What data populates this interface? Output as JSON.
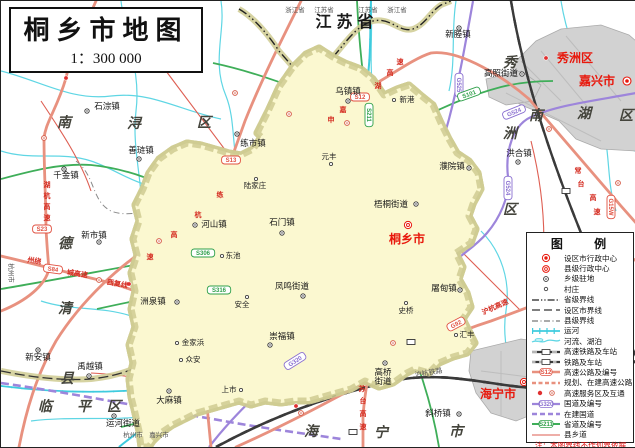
{
  "title": {
    "text": "桐乡市地图",
    "scale": "1：300 000"
  },
  "legend": {
    "title": "图  例",
    "items": [
      {
        "label": "设区市行政中心"
      },
      {
        "label": "县级行政中心"
      },
      {
        "label": "乡级驻地"
      },
      {
        "label": "村庄"
      },
      {
        "label": "省级界线"
      },
      {
        "label": "设区市界线"
      },
      {
        "label": "县级界线"
      },
      {
        "label": "运河"
      },
      {
        "label": "河流、湖泊"
      },
      {
        "label": "高速铁路及车站"
      },
      {
        "label": "铁路及车站"
      },
      {
        "label": "高速公路及编号"
      },
      {
        "label": "规划、在建高速公路"
      },
      {
        "label": "高速服务区及互通"
      },
      {
        "label": "国道及编号"
      },
      {
        "label": "在建国道"
      },
      {
        "label": "省道及编号"
      },
      {
        "label": "县乡道"
      }
    ],
    "badge_expwy": "S12",
    "badge_national": "G320",
    "badge_provincial": "S211",
    "notes": [
      "注：本图界线不作划界依据",
      "地图审核号：浙S(2024)38号"
    ]
  },
  "colors": {
    "land": "#FBF8D0",
    "outside": "#FFFFFF",
    "boundary": "#8C8C3A",
    "halo": "#CFCB92",
    "water": "#4FD2E2",
    "expressway": "#E8917F",
    "national": "#9D85DB",
    "provincial": "#3FAE59",
    "county_road": "#DE5E52",
    "urban_tx": "#F0B45E",
    "urban_gray": "#D2D2D2",
    "red_text": "#E8180C"
  },
  "map": {
    "labels": [
      {
        "t": "江苏省",
        "x": 346,
        "y": 26,
        "c": "prov"
      },
      {
        "t": "浙江省",
        "x": 294,
        "y": 11,
        "c": "bord"
      },
      {
        "t": "江苏省",
        "x": 323,
        "y": 11,
        "c": "bord"
      },
      {
        "t": "江苏省",
        "x": 367,
        "y": 11,
        "c": "bord"
      },
      {
        "t": "浙江省",
        "x": 396,
        "y": 11,
        "c": "bord"
      },
      {
        "t": "杭州市",
        "x": 132,
        "y": 436,
        "c": "bord"
      },
      {
        "t": "嘉兴市",
        "x": 158,
        "y": 436,
        "c": "bord"
      },
      {
        "t": "杭州市",
        "x": 8,
        "y": 272,
        "c": "bord",
        "r": 90
      },
      {
        "t": "南",
        "x": 63,
        "y": 126,
        "c": "dist"
      },
      {
        "t": "浔",
        "x": 133,
        "y": 127,
        "c": "dist"
      },
      {
        "t": "区",
        "x": 203,
        "y": 126,
        "c": "dist"
      },
      {
        "t": "德",
        "x": 64,
        "y": 247,
        "c": "dist"
      },
      {
        "t": "清",
        "x": 64,
        "y": 312,
        "c": "dist"
      },
      {
        "t": "县",
        "x": 66,
        "y": 382,
        "c": "dist"
      },
      {
        "t": "临",
        "x": 44,
        "y": 410,
        "c": "dist"
      },
      {
        "t": "平",
        "x": 83,
        "y": 410,
        "c": "dist"
      },
      {
        "t": "区",
        "x": 113,
        "y": 410,
        "c": "dist"
      },
      {
        "t": "海",
        "x": 310,
        "y": 435,
        "c": "dist"
      },
      {
        "t": "宁",
        "x": 380,
        "y": 436,
        "c": "dist"
      },
      {
        "t": "市",
        "x": 455,
        "y": 435,
        "c": "dist"
      },
      {
        "t": "秀",
        "x": 509,
        "y": 66,
        "c": "dist"
      },
      {
        "t": "洲",
        "x": 509,
        "y": 137,
        "c": "dist"
      },
      {
        "t": "区",
        "x": 509,
        "y": 213,
        "c": "dist"
      },
      {
        "t": "南",
        "x": 535,
        "y": 119,
        "c": "dist"
      },
      {
        "t": "湖",
        "x": 583,
        "y": 117,
        "c": "dist"
      },
      {
        "t": "区",
        "x": 625,
        "y": 119,
        "c": "dist"
      },
      {
        "t": "南",
        "x": 626,
        "y": 309,
        "c": "dsm"
      },
      {
        "t": "湖",
        "x": 627,
        "y": 324,
        "c": "dsm"
      },
      {
        "t": "区",
        "x": 627,
        "y": 339,
        "c": "dsm"
      },
      {
        "t": "秀洲区",
        "x": 574,
        "y": 61,
        "c": "cred"
      },
      {
        "t": "嘉兴市",
        "x": 596,
        "y": 84,
        "c": "cred"
      },
      {
        "t": "桐乡市",
        "x": 406,
        "y": 242,
        "c": "cred"
      },
      {
        "t": "海宁市",
        "x": 497,
        "y": 397,
        "c": "cred"
      },
      {
        "t": "双林镇",
        "x": 152,
        "y": 42,
        "c": "town"
      },
      {
        "t": "石淙镇",
        "x": 106,
        "y": 108,
        "c": "town"
      },
      {
        "t": "善琏镇",
        "x": 140,
        "y": 152,
        "c": "town"
      },
      {
        "t": "千金镇",
        "x": 65,
        "y": 177,
        "c": "town"
      },
      {
        "t": "新市镇",
        "x": 93,
        "y": 237,
        "c": "town"
      },
      {
        "t": "练市镇",
        "x": 252,
        "y": 145,
        "c": "town"
      },
      {
        "t": "乌镇镇",
        "x": 347,
        "y": 93,
        "c": "town"
      },
      {
        "t": "新塍镇",
        "x": 457,
        "y": 36,
        "c": "town"
      },
      {
        "t": "高照街道",
        "x": 500,
        "y": 75,
        "c": "town"
      },
      {
        "t": "洪合镇",
        "x": 518,
        "y": 155,
        "c": "town"
      },
      {
        "t": "濮院镇",
        "x": 451,
        "y": 168,
        "c": "town"
      },
      {
        "t": "梧桐街道",
        "x": 390,
        "y": 206,
        "c": "town"
      },
      {
        "t": "石门镇",
        "x": 281,
        "y": 224,
        "c": "town"
      },
      {
        "t": "河山镇",
        "x": 213,
        "y": 226,
        "c": "town"
      },
      {
        "t": "洲泉镇",
        "x": 152,
        "y": 303,
        "c": "town"
      },
      {
        "t": "凤鸣街道",
        "x": 291,
        "y": 288,
        "c": "town"
      },
      {
        "t": "崇福镇",
        "x": 281,
        "y": 338,
        "c": "town"
      },
      {
        "t": "屠甸镇",
        "x": 443,
        "y": 290,
        "c": "town"
      },
      {
        "t": "高桥",
        "x": 382,
        "y": 374,
        "c": "town"
      },
      {
        "t": "街道",
        "x": 382,
        "y": 383,
        "c": "town"
      },
      {
        "t": "斜桥镇",
        "x": 437,
        "y": 415,
        "c": "town"
      },
      {
        "t": "新安镇",
        "x": 37,
        "y": 359,
        "c": "town"
      },
      {
        "t": "禹越镇",
        "x": 89,
        "y": 368,
        "c": "town"
      },
      {
        "t": "大麻镇",
        "x": 168,
        "y": 402,
        "c": "town"
      },
      {
        "t": "运河街道",
        "x": 122,
        "y": 425,
        "c": "town"
      },
      {
        "t": "新港",
        "x": 406,
        "y": 101,
        "c": "vill"
      },
      {
        "t": "元丰",
        "x": 328,
        "y": 158,
        "c": "vill"
      },
      {
        "t": "陆家庄",
        "x": 254,
        "y": 187,
        "c": "vill"
      },
      {
        "t": "东池",
        "x": 232,
        "y": 257,
        "c": "vill"
      },
      {
        "t": "安全",
        "x": 241,
        "y": 306,
        "c": "vill"
      },
      {
        "t": "金家浜",
        "x": 192,
        "y": 344,
        "c": "vill"
      },
      {
        "t": "众安",
        "x": 192,
        "y": 361,
        "c": "vill"
      },
      {
        "t": "上市",
        "x": 228,
        "y": 391,
        "c": "vill"
      },
      {
        "t": "史桥",
        "x": 405,
        "y": 312,
        "c": "vill"
      },
      {
        "t": "汇丰",
        "x": 466,
        "y": 336,
        "c": "vill"
      },
      {
        "t": "申",
        "x": 330,
        "y": 121,
        "c": "road"
      },
      {
        "t": "嘉",
        "x": 342,
        "y": 111,
        "c": "road"
      },
      {
        "t": "湖",
        "x": 377,
        "y": 87,
        "c": "road"
      },
      {
        "t": "高",
        "x": 389,
        "y": 74,
        "c": "road"
      },
      {
        "t": "速",
        "x": 399,
        "y": 63,
        "c": "road"
      },
      {
        "t": "练",
        "x": 219,
        "y": 196,
        "c": "road"
      },
      {
        "t": "杭",
        "x": 197,
        "y": 216,
        "c": "road"
      },
      {
        "t": "高",
        "x": 173,
        "y": 236,
        "c": "road"
      },
      {
        "t": "速",
        "x": 149,
        "y": 258,
        "c": "road"
      },
      {
        "t": "湖",
        "x": 46,
        "y": 186,
        "c": "road"
      },
      {
        "t": "杭",
        "x": 46,
        "y": 197,
        "c": "road"
      },
      {
        "t": "高",
        "x": 46,
        "y": 208,
        "c": "road"
      },
      {
        "t": "速",
        "x": 46,
        "y": 219,
        "c": "road"
      },
      {
        "t": "州绕",
        "x": 33,
        "y": 262,
        "c": "road",
        "r": 8
      },
      {
        "t": "城高速",
        "x": 76,
        "y": 275,
        "c": "road",
        "r": 8
      },
      {
        "t": "西复线",
        "x": 116,
        "y": 285,
        "c": "road",
        "r": 10
      },
      {
        "t": "苏",
        "x": 361,
        "y": 390,
        "c": "road"
      },
      {
        "t": "台",
        "x": 362,
        "y": 402,
        "c": "road"
      },
      {
        "t": "高",
        "x": 362,
        "y": 415,
        "c": "road"
      },
      {
        "t": "速",
        "x": 362,
        "y": 428,
        "c": "road"
      },
      {
        "t": "常",
        "x": 577,
        "y": 172,
        "c": "road"
      },
      {
        "t": "台",
        "x": 580,
        "y": 185,
        "c": "road"
      },
      {
        "t": "高",
        "x": 592,
        "y": 199,
        "c": "road"
      },
      {
        "t": "速",
        "x": 596,
        "y": 213,
        "c": "road"
      },
      {
        "t": "沪杭高速",
        "x": 495,
        "y": 308,
        "c": "road",
        "r": -24
      },
      {
        "t": "沪杭铁路",
        "x": 428,
        "y": 374,
        "c": "rail",
        "r": -10
      }
    ],
    "badges": [
      {
        "t": "S12",
        "x": 359,
        "y": 96,
        "c": "e"
      },
      {
        "t": "S13",
        "x": 230,
        "y": 159,
        "c": "e"
      },
      {
        "t": "S23",
        "x": 41,
        "y": 228,
        "c": "e"
      },
      {
        "t": "S84",
        "x": 52,
        "y": 268,
        "c": "e",
        "r": 8
      },
      {
        "t": "G92",
        "x": 455,
        "y": 323,
        "c": "e",
        "r": -28
      },
      {
        "t": "G15W",
        "x": 610,
        "y": 206,
        "c": "e",
        "v": 1
      },
      {
        "t": "G525",
        "x": 458,
        "y": 84,
        "c": "n",
        "v": 1
      },
      {
        "t": "G524",
        "x": 513,
        "y": 111,
        "c": "n",
        "r": -22
      },
      {
        "t": "G524",
        "x": 507,
        "y": 187,
        "c": "n",
        "v": 1
      },
      {
        "t": "G320",
        "x": 294,
        "y": 360,
        "c": "n",
        "r": -32
      },
      {
        "t": "S211",
        "x": 368,
        "y": 114,
        "c": "p",
        "v": 1
      },
      {
        "t": "S306",
        "x": 202,
        "y": 252,
        "c": "p"
      },
      {
        "t": "S316",
        "x": 218,
        "y": 289,
        "c": "p"
      },
      {
        "t": "S101",
        "x": 468,
        "y": 93,
        "c": "p",
        "r": -20
      }
    ],
    "markers": [
      {
        "x": 626,
        "y": 80,
        "ty": "city"
      },
      {
        "x": 407,
        "y": 224,
        "ty": "county"
      },
      {
        "x": 523,
        "y": 381,
        "ty": "county"
      },
      {
        "x": 545,
        "y": 57,
        "ty": "svc"
      },
      {
        "x": 150,
        "y": 48,
        "ty": "town"
      },
      {
        "x": 86,
        "y": 110,
        "ty": "town"
      },
      {
        "x": 138,
        "y": 158,
        "ty": "town"
      },
      {
        "x": 63,
        "y": 168,
        "ty": "town"
      },
      {
        "x": 98,
        "y": 241,
        "ty": "town"
      },
      {
        "x": 236,
        "y": 133,
        "ty": "town"
      },
      {
        "x": 347,
        "y": 100,
        "ty": "town"
      },
      {
        "x": 458,
        "y": 27,
        "ty": "town"
      },
      {
        "x": 521,
        "y": 73,
        "ty": "town"
      },
      {
        "x": 517,
        "y": 161,
        "ty": "town"
      },
      {
        "x": 468,
        "y": 167,
        "ty": "town"
      },
      {
        "x": 415,
        "y": 203,
        "ty": "town"
      },
      {
        "x": 281,
        "y": 232,
        "ty": "town"
      },
      {
        "x": 194,
        "y": 224,
        "ty": "town"
      },
      {
        "x": 176,
        "y": 301,
        "ty": "town"
      },
      {
        "x": 302,
        "y": 295,
        "ty": "town"
      },
      {
        "x": 269,
        "y": 344,
        "ty": "town"
      },
      {
        "x": 459,
        "y": 289,
        "ty": "town"
      },
      {
        "x": 384,
        "y": 362,
        "ty": "town"
      },
      {
        "x": 458,
        "y": 413,
        "ty": "town"
      },
      {
        "x": 37,
        "y": 349,
        "ty": "town"
      },
      {
        "x": 88,
        "y": 375,
        "ty": "town"
      },
      {
        "x": 168,
        "y": 390,
        "ty": "town"
      },
      {
        "x": 113,
        "y": 415,
        "ty": "town"
      },
      {
        "x": 393,
        "y": 99,
        "ty": "vill"
      },
      {
        "x": 330,
        "y": 163,
        "ty": "vill"
      },
      {
        "x": 255,
        "y": 178,
        "ty": "vill"
      },
      {
        "x": 221,
        "y": 255,
        "ty": "vill"
      },
      {
        "x": 246,
        "y": 296,
        "ty": "vill"
      },
      {
        "x": 176,
        "y": 342,
        "ty": "vill"
      },
      {
        "x": 180,
        "y": 359,
        "ty": "vill"
      },
      {
        "x": 240,
        "y": 389,
        "ty": "vill"
      },
      {
        "x": 405,
        "y": 302,
        "ty": "vill"
      },
      {
        "x": 455,
        "y": 334,
        "ty": "vill"
      },
      {
        "x": 43,
        "y": 137,
        "ty": "ic"
      },
      {
        "x": 98,
        "y": 279,
        "ty": "ic"
      },
      {
        "x": 158,
        "y": 240,
        "ty": "ic"
      },
      {
        "x": 234,
        "y": 92,
        "ty": "ic"
      },
      {
        "x": 288,
        "y": 113,
        "ty": "ic"
      },
      {
        "x": 346,
        "y": 122,
        "ty": "ic"
      },
      {
        "x": 392,
        "y": 342,
        "ty": "ic"
      },
      {
        "x": 560,
        "y": 292,
        "ty": "ic"
      },
      {
        "x": 548,
        "y": 128,
        "ty": "ic"
      },
      {
        "x": 617,
        "y": 182,
        "ty": "ic"
      },
      {
        "x": 300,
        "y": 412,
        "ty": "ic"
      },
      {
        "x": 65,
        "y": 77,
        "ty": "svc"
      },
      {
        "x": 128,
        "y": 283,
        "ty": "svc"
      },
      {
        "x": 295,
        "y": 405,
        "ty": "svc"
      },
      {
        "x": 352,
        "y": 431,
        "ty": "sta"
      },
      {
        "x": 537,
        "y": 383,
        "ty": "sta"
      },
      {
        "x": 565,
        "y": 190,
        "ty": "sta"
      },
      {
        "x": 410,
        "y": 341,
        "ty": "sta"
      }
    ]
  }
}
